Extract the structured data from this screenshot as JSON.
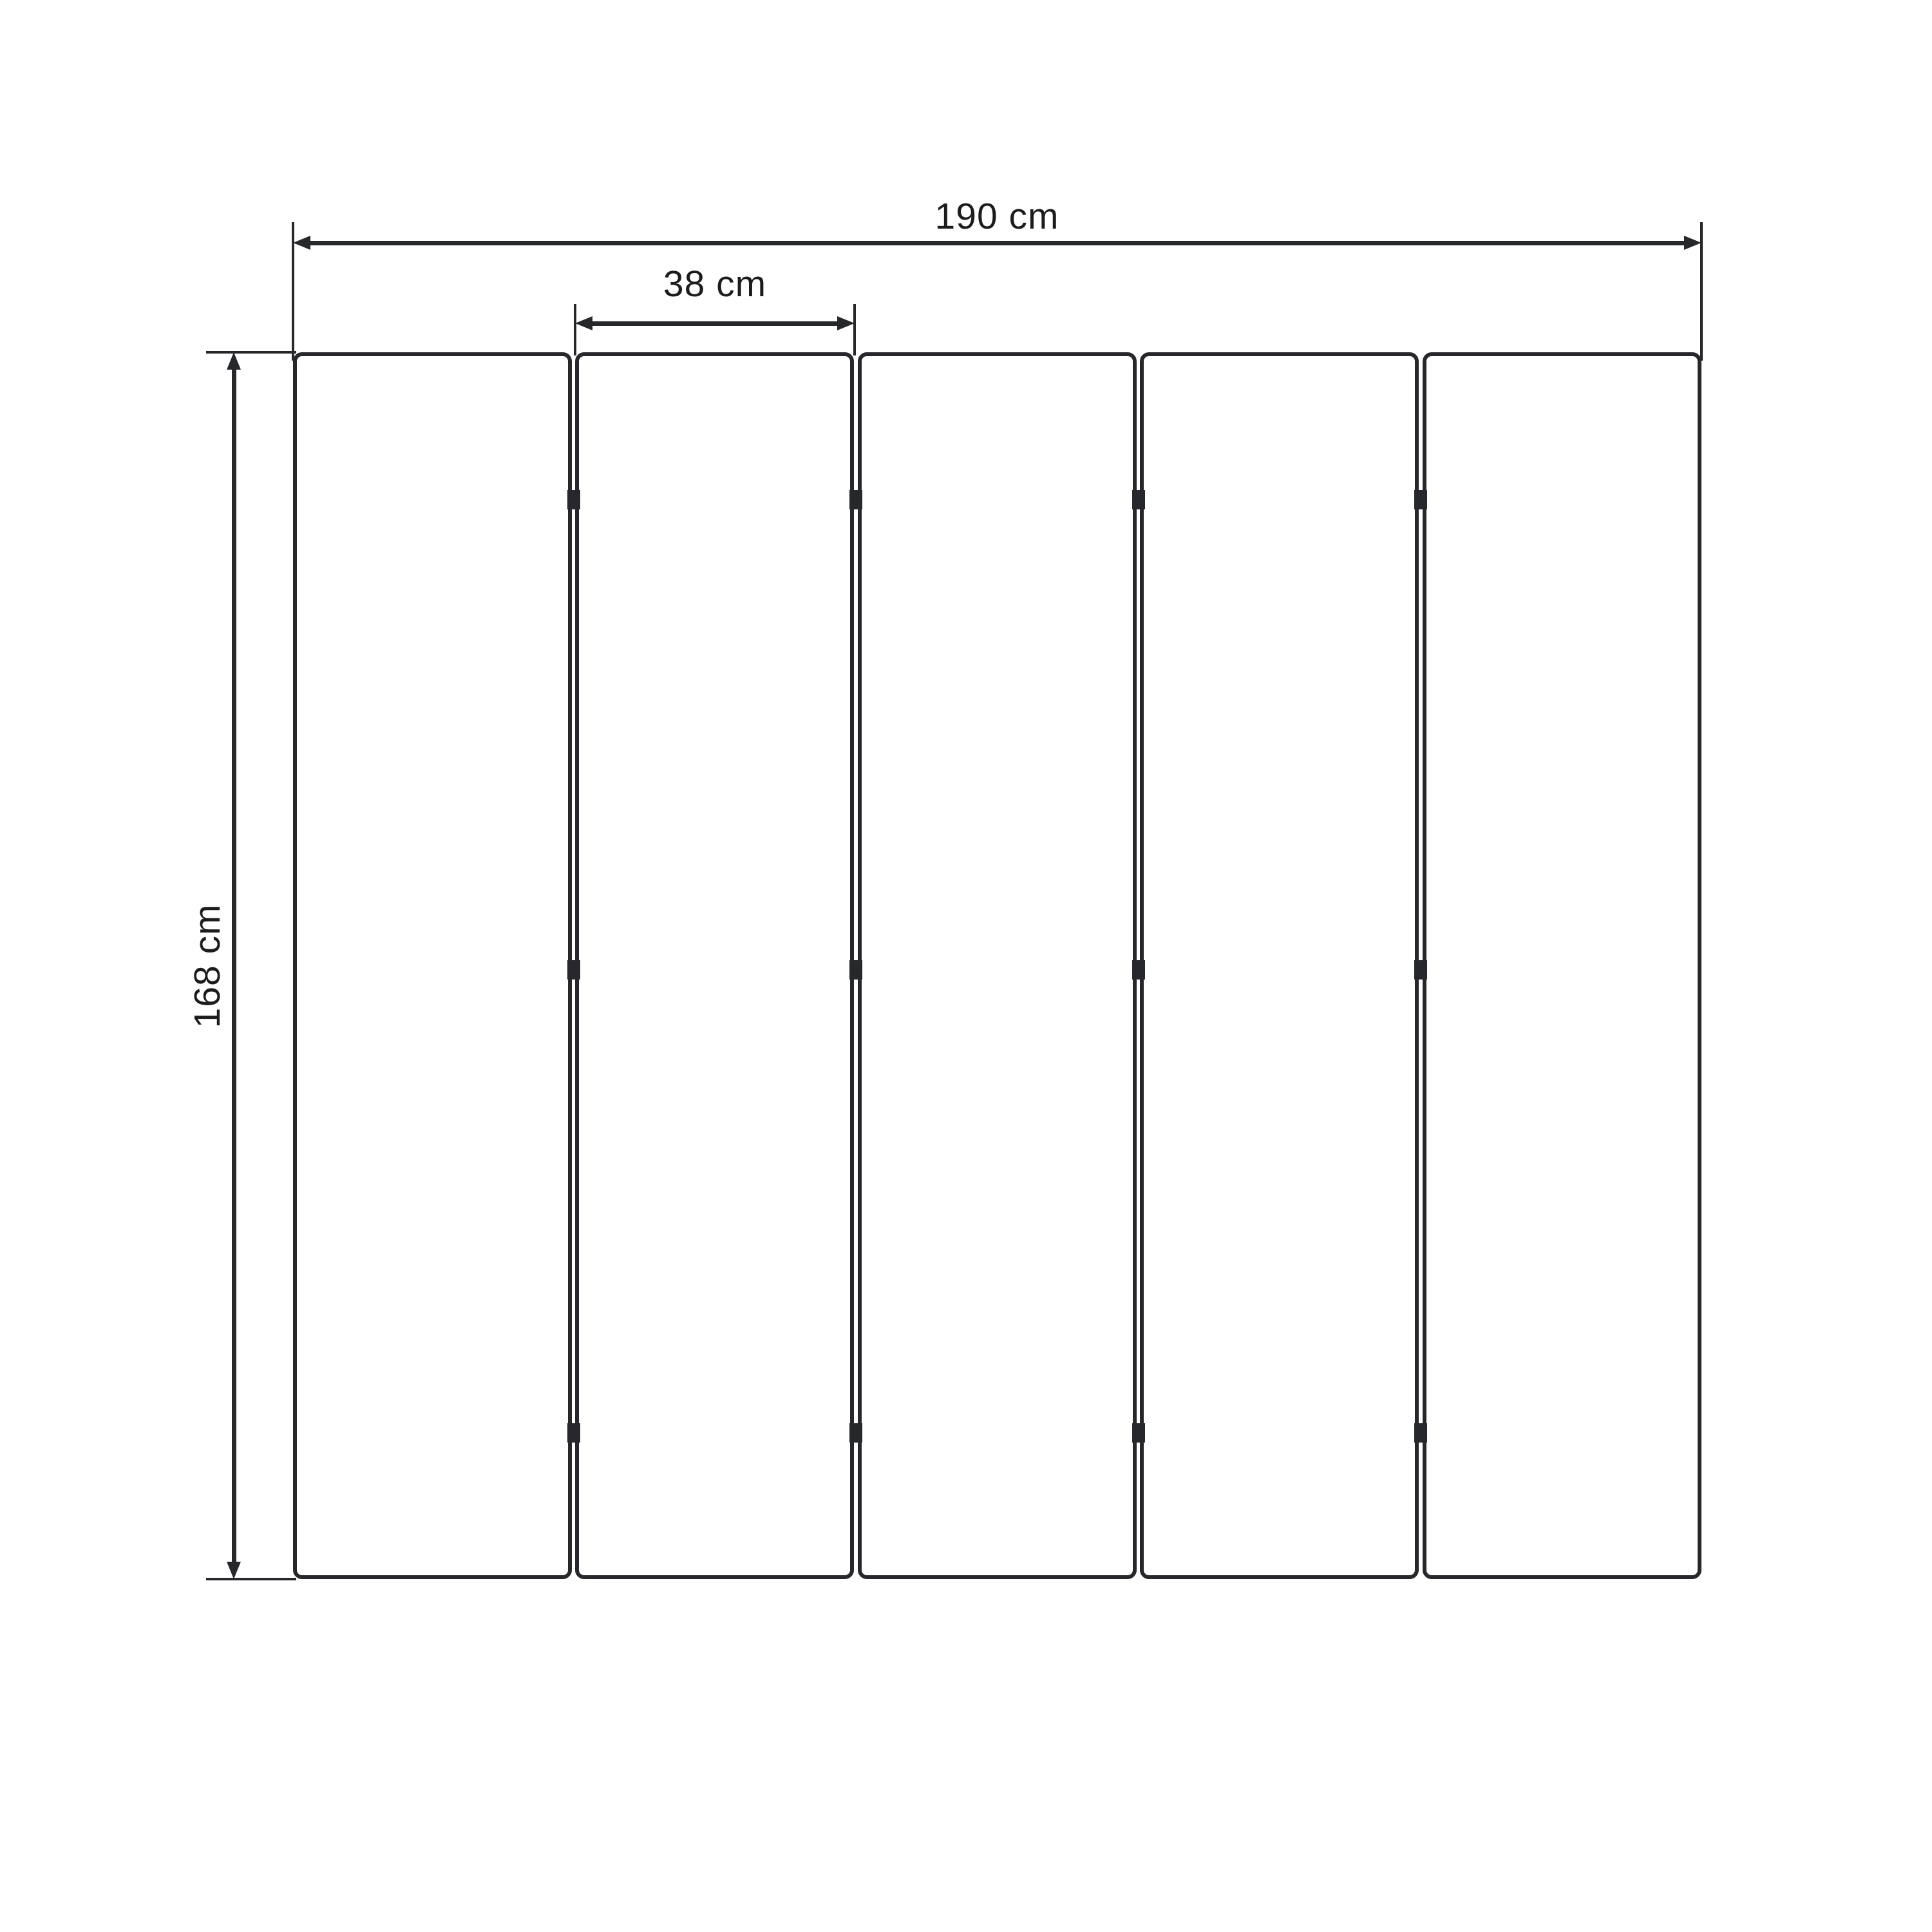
{
  "diagram": {
    "type": "dimension-drawing",
    "subject": "five-panel folding screen front view",
    "panel_count": 5,
    "labels": {
      "total_width": "190 cm",
      "panel_width": "38 cm",
      "panel_height": "168 cm"
    },
    "colors": {
      "background": "#ffffff",
      "line": "#26282b",
      "text": "#1c1c1c"
    }
  }
}
